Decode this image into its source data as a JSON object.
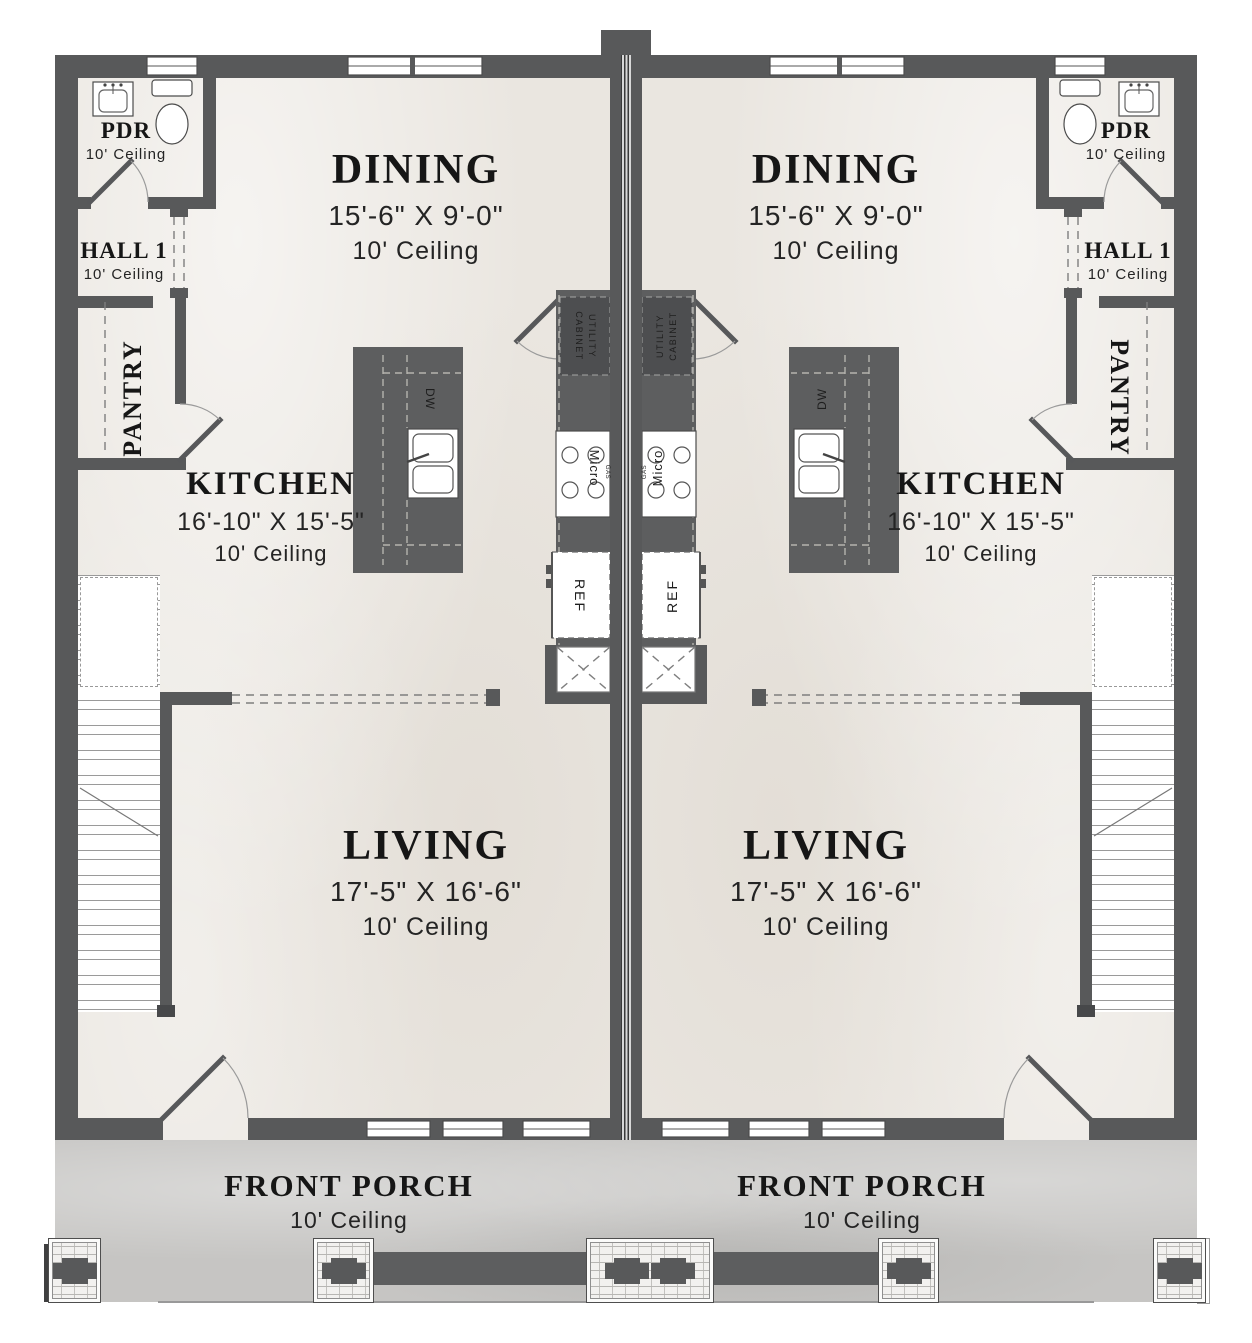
{
  "colors": {
    "wall": "#58595a",
    "floor": "#eae6e0",
    "porch": "#c6c5c3",
    "cabinet": "#5d5e5f",
    "text": "#1c1c1c"
  },
  "units": [
    {
      "id": "left-unit",
      "rooms": {
        "dining": {
          "name": "DINING",
          "dims": "15'-6\" X 9'-0\"",
          "ceiling": "10' Ceiling"
        },
        "kitchen": {
          "name": "KITCHEN",
          "dims": "16'-10\" X 15'-5\"",
          "ceiling": "10' Ceiling"
        },
        "living": {
          "name": "LIVING",
          "dims": "17'-5\" X 16'-6\"",
          "ceiling": "10' Ceiling"
        },
        "pdr": {
          "name": "PDR",
          "ceiling": "10' Ceiling"
        },
        "hall": {
          "name": "HALL 1",
          "ceiling": "10' Ceiling"
        },
        "pantry": {
          "name": "PANTRY"
        },
        "porch": {
          "name": "FRONT PORCH",
          "ceiling": "10' Ceiling"
        }
      },
      "fixtures": {
        "utility_line1": "UTILITY",
        "utility_line2": "CABINET",
        "dw": "DW",
        "micro": "Micro",
        "gas": "GAS",
        "ref": "REF"
      }
    },
    {
      "id": "right-unit",
      "rooms": {
        "dining": {
          "name": "DINING",
          "dims": "15'-6\" X 9'-0\"",
          "ceiling": "10' Ceiling"
        },
        "kitchen": {
          "name": "KITCHEN",
          "dims": "16'-10\" X 15'-5\"",
          "ceiling": "10' Ceiling"
        },
        "living": {
          "name": "LIVING",
          "dims": "17'-5\" X 16'-6\"",
          "ceiling": "10' Ceiling"
        },
        "pdr": {
          "name": "PDR",
          "ceiling": "10' Ceiling"
        },
        "hall": {
          "name": "HALL 1",
          "ceiling": "10' Ceiling"
        },
        "pantry": {
          "name": "PANTRY"
        },
        "porch": {
          "name": "FRONT PORCH",
          "ceiling": "10' Ceiling"
        }
      },
      "fixtures": {
        "utility_line1": "UTILITY",
        "utility_line2": "CABINET",
        "dw": "DW",
        "micro": "Micro",
        "gas": "GAS",
        "ref": "REF"
      }
    }
  ]
}
